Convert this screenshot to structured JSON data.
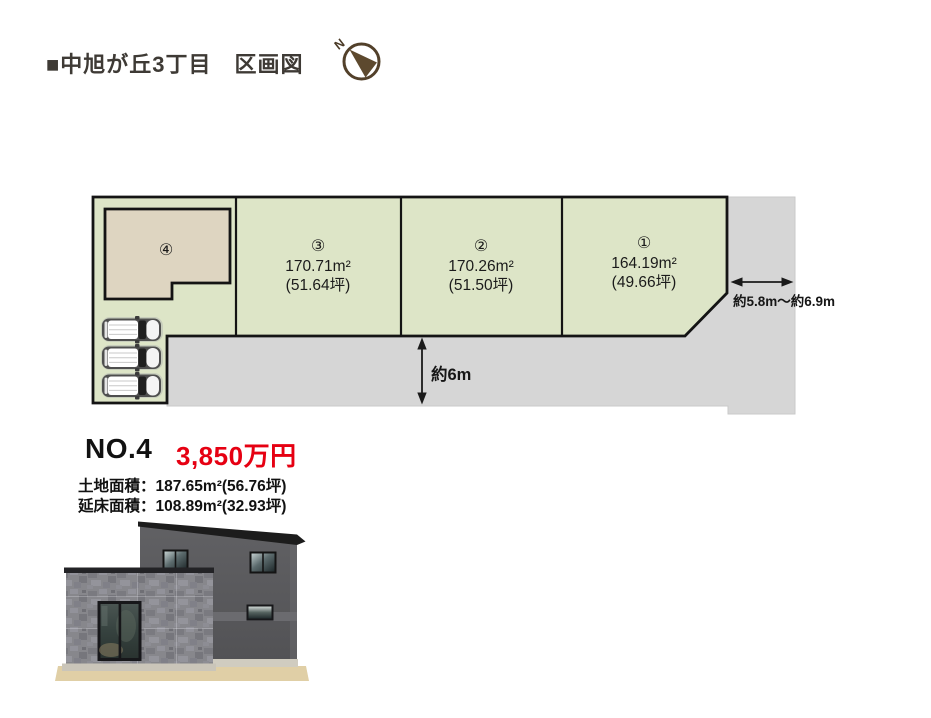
{
  "header": {
    "title": "■中旭が丘3丁目　区画図",
    "compass_n": "N"
  },
  "plan": {
    "lots": [
      {
        "number": "①",
        "area": "164.19m²",
        "tsubo": "(49.66坪)"
      },
      {
        "number": "②",
        "area": "170.26m²",
        "tsubo": "(51.50坪)"
      },
      {
        "number": "③",
        "area": "170.71m²",
        "tsubo": "(51.64坪)"
      },
      {
        "number": "④"
      }
    ],
    "road_width_label": "約6m",
    "side_road_width_label": "約5.8m～約6.9m"
  },
  "detail": {
    "lot_no": "NO.4",
    "price": "3,850万円",
    "land_area": "土地面積：187.65m²(56.76坪)",
    "floor_area": "延床面積：108.89m²(32.93坪)"
  },
  "colors": {
    "lot_green": "#dde5c7",
    "road_gray": "#d6d6d6",
    "building_beige": "#ded5c1",
    "outline": "#141414",
    "price_red": "#e60012",
    "compass_brown": "#5d492e"
  }
}
